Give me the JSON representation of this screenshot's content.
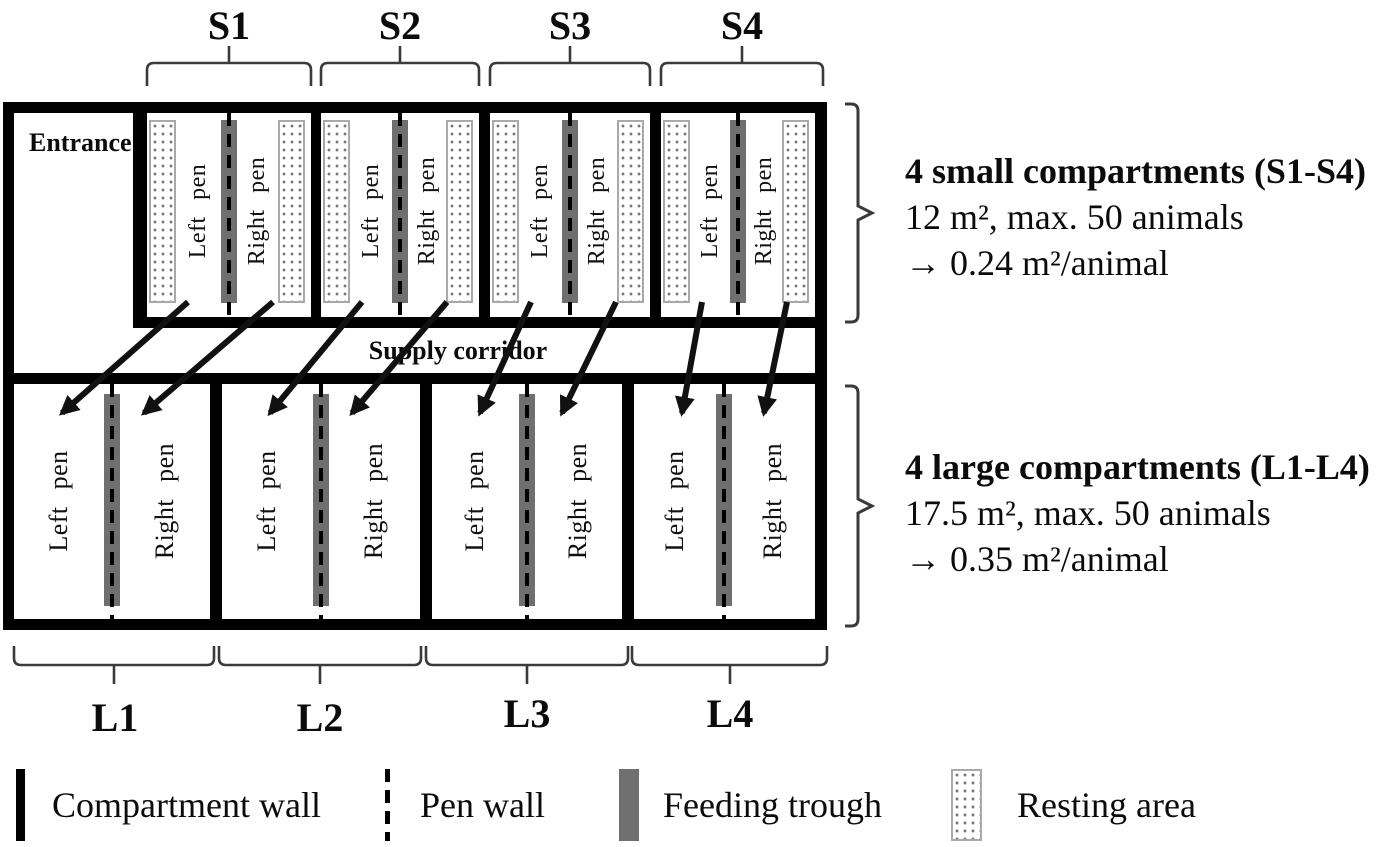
{
  "figure": {
    "small_section_labels": [
      "S1",
      "S2",
      "S3",
      "S4"
    ],
    "large_section_labels": [
      "L1",
      "L2",
      "L3",
      "L4"
    ],
    "entrance_label": "Entrance",
    "supply_corridor_label": "Supply corridor",
    "left_pen_label": "Left pen",
    "right_pen_label": "Right pen"
  },
  "annotations": {
    "small": {
      "title": "4 small compartments (S1-S4)",
      "detail": "12 m², max. 50 animals",
      "density": "→ 0.24 m²/animal"
    },
    "large": {
      "title": "4 large compartments (L1-L4)",
      "detail": "17.5 m², max. 50 animals",
      "density": "→ 0.35 m²/animal"
    }
  },
  "legend": {
    "items": [
      {
        "symbol": "compartment-wall",
        "label": "Compartment wall"
      },
      {
        "symbol": "pen-wall",
        "label": "Pen wall"
      },
      {
        "symbol": "feeding-trough",
        "label": "Feeding trough"
      },
      {
        "symbol": "resting-area",
        "label": "Resting area"
      }
    ]
  },
  "colors": {
    "wall": "#000000",
    "feeding_trough": "#6f6f6f",
    "resting_dot": "#7a7a7a",
    "brace": "#3a3a3a"
  }
}
